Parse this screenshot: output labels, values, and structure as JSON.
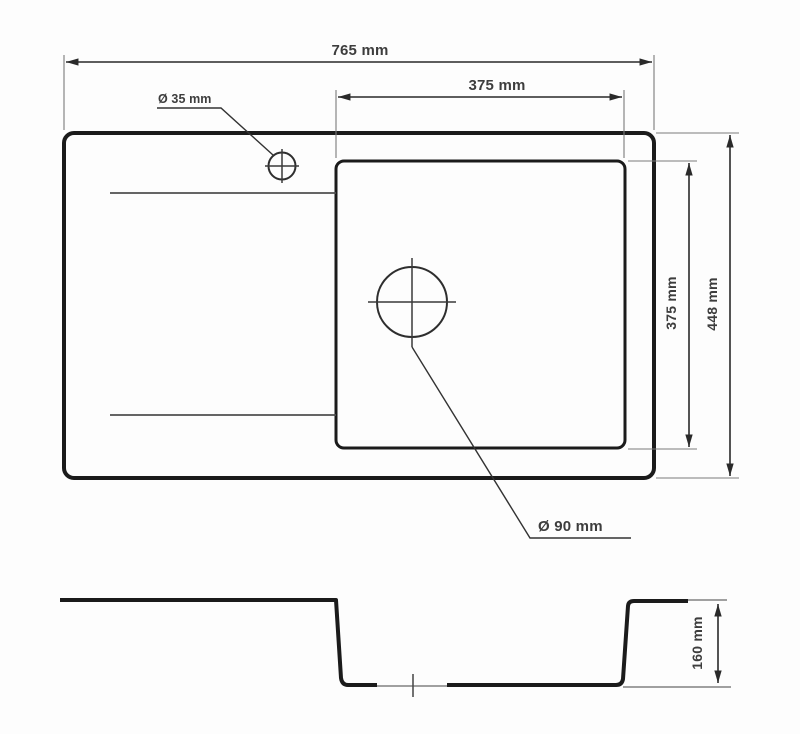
{
  "colors": {
    "background": "#fdfdfd",
    "outline_heavy": "#1b1b1b",
    "dimension_line": "#2a2a2a",
    "extension_line": "#7a7a7a",
    "text": "#3d3d3d"
  },
  "top_view": {
    "overall_width_label": "765 mm",
    "bowl_width_label": "375 mm",
    "bowl_depth_label": "375 mm",
    "overall_depth_label": "448 mm",
    "faucet_hole_label": "Ø 35 mm",
    "drain_hole_label": "Ø 90 mm"
  },
  "section_view": {
    "bowl_height_label": "160 mm"
  }
}
